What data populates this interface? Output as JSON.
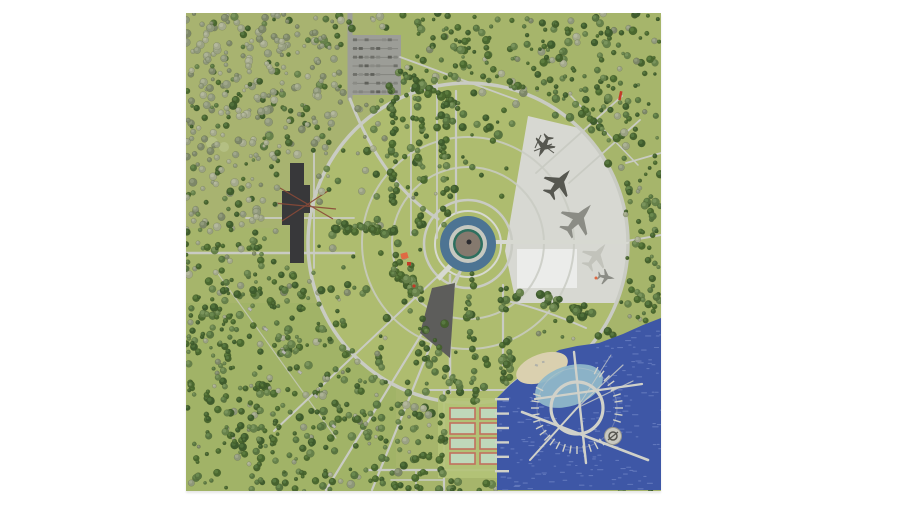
{
  "page": {
    "width": 900,
    "height": 506,
    "background": "#ffffff"
  },
  "plan": {
    "left": 186,
    "top": 13,
    "width": 475,
    "height": 478,
    "label": "park-masterplan-aerial-render"
  },
  "colors": {
    "field": "#a6b56b",
    "field_khaki": "#aab277",
    "field_dark": "#9cb162",
    "lawn": "#aebc6f",
    "pale_circle": "#b9c48b",
    "path": "#c9cbc3",
    "path_bright": "#d7d9d1",
    "road": "#9d9e98",
    "plaza": "#d7d8d2",
    "plaza_white": "#ebecea",
    "parking": "#9c9d97",
    "parking_line": "#83847e",
    "car_dark": "#5f605a",
    "building_dark": "#38383a",
    "crane": "#8a4a38",
    "pond_blue": "#4d7493",
    "pond_ring_gray": "#c6c8c0",
    "pond_teal": "#2e6f5e",
    "pond_center": "#85796e",
    "pond_dot": "#2b2b30",
    "wedge": "#5d5d5b",
    "water": "#3e57a6",
    "water_light": "#7e91cd",
    "lagoon": "#8fb7c8",
    "sand": "#dad0af",
    "pier": "#d0d1c9",
    "pier_dim": "#b9bab2",
    "pad_fill": "#c8c8c0",
    "pad_edge": "#97978f",
    "pad_glyph": "#55554f",
    "court_border": "#c2705e",
    "court_fill": "#bfd8ba",
    "courts_pad": "#b4c378",
    "red": "#c23b28",
    "red2": "#e06a43",
    "plane_dark": "#565750",
    "plane_mid": "#8b8c85",
    "plane_light": "#c2c3bb",
    "hut": "#b0b1a9",
    "pavilion": "#b9bab2",
    "pavilion_edge": "#8a8b85"
  },
  "regions": {
    "water_points": "311,477 311,385 324,372 341,358 357,347 373,337 391,333 413,330 437,321 457,312 475,305 475,477",
    "plaza_d": "M342,103 L393,115 A160 160 0 0 1 430,290 L330,290 L319,238 Z"
  },
  "gen": {
    "seed": 1337,
    "trees": {
      "count": 1300,
      "inner_keep_left": 0.3,
      "inner_keep_right": 0.14,
      "min_r": 1.6,
      "var_r": 2.6,
      "palette": [
        [
          "#3f5c2d",
          "#50703a"
        ],
        [
          "#4a682f",
          "#5c7c3e"
        ],
        [
          "#587440",
          "#6a894e"
        ],
        [
          "#66814a",
          "#7a945c"
        ],
        [
          "#46622e",
          "#587841"
        ]
      ],
      "gray_palette": [
        [
          "#8e977a",
          "#a0a78b"
        ],
        [
          "#9aa183",
          "#acb295"
        ],
        [
          "#7d8768",
          "#909a7a"
        ],
        [
          "#a4a98c",
          "#b4b89d"
        ]
      ],
      "gray_region": {
        "x_max": 200,
        "y_max": 215,
        "prob": 0.6
      },
      "gray_scatter_prob": 0.12,
      "exclude_plaza": [
        [
          335,
          100
        ],
        [
          400,
          112
        ],
        [
          442,
          230
        ],
        [
          428,
          295
        ],
        [
          318,
          295
        ],
        [
          316,
          235
        ]
      ],
      "exclude_rects": [
        [
          158,
          16,
          62,
          70
        ],
        [
          248,
          380,
          84,
          88
        ],
        [
          93,
          146,
          38,
          108
        ]
      ],
      "exclude_circles": [
        [
          282,
          231,
          48
        ],
        [
          356,
          355,
          30
        ],
        [
          427,
          423,
          14
        ]
      ],
      "lawn_circle": [
        282,
        230,
        160
      ]
    },
    "tree_bands": [
      [
        207,
        62,
        207,
        210,
        30,
        3,
        4
      ],
      [
        233,
        70,
        233,
        215,
        30,
        3,
        4
      ],
      [
        259,
        62,
        259,
        212,
        30,
        3,
        4
      ],
      [
        207,
        57,
        310,
        118,
        26,
        3.5,
        5
      ],
      [
        144,
        212,
        228,
        222,
        30,
        3.5,
        5
      ],
      [
        200,
        240,
        232,
        285,
        26,
        3.5,
        7
      ],
      [
        318,
        268,
        322,
        395,
        30,
        3.5,
        5
      ],
      [
        330,
        280,
        402,
        300,
        24,
        3.5,
        6
      ],
      [
        284,
        262,
        290,
        390,
        22,
        3,
        4
      ],
      [
        255,
        380,
        258,
        470,
        14,
        3,
        4
      ],
      [
        230,
        340,
        275,
        370,
        14,
        3,
        6
      ]
    ],
    "waves": {
      "count": 170,
      "lagoon_skip": [
        383,
        373,
        34
      ],
      "sand_skip": [
        356,
        355,
        28
      ]
    },
    "parking": {
      "x": 163,
      "y": 22,
      "w": 52,
      "h": 60,
      "rows": 7,
      "dashes_per_row": 8
    },
    "marina_ticks": {
      "cx": 391,
      "cy": 395,
      "start_deg": -63,
      "end_deg": 214,
      "step_deg": 9,
      "skip_from": 24,
      "skip_to": 52,
      "r1": 38,
      "r2": 46
    },
    "finger_piers": {
      "count": 6,
      "x": 309,
      "y0": 385,
      "dy": 14.4,
      "w": 14,
      "h": 2.4
    },
    "courts": {
      "col_x": [
        264,
        294
      ],
      "row_y0": 395,
      "row_dy": 15,
      "rows": 4,
      "w": 25,
      "h": 11
    }
  }
}
